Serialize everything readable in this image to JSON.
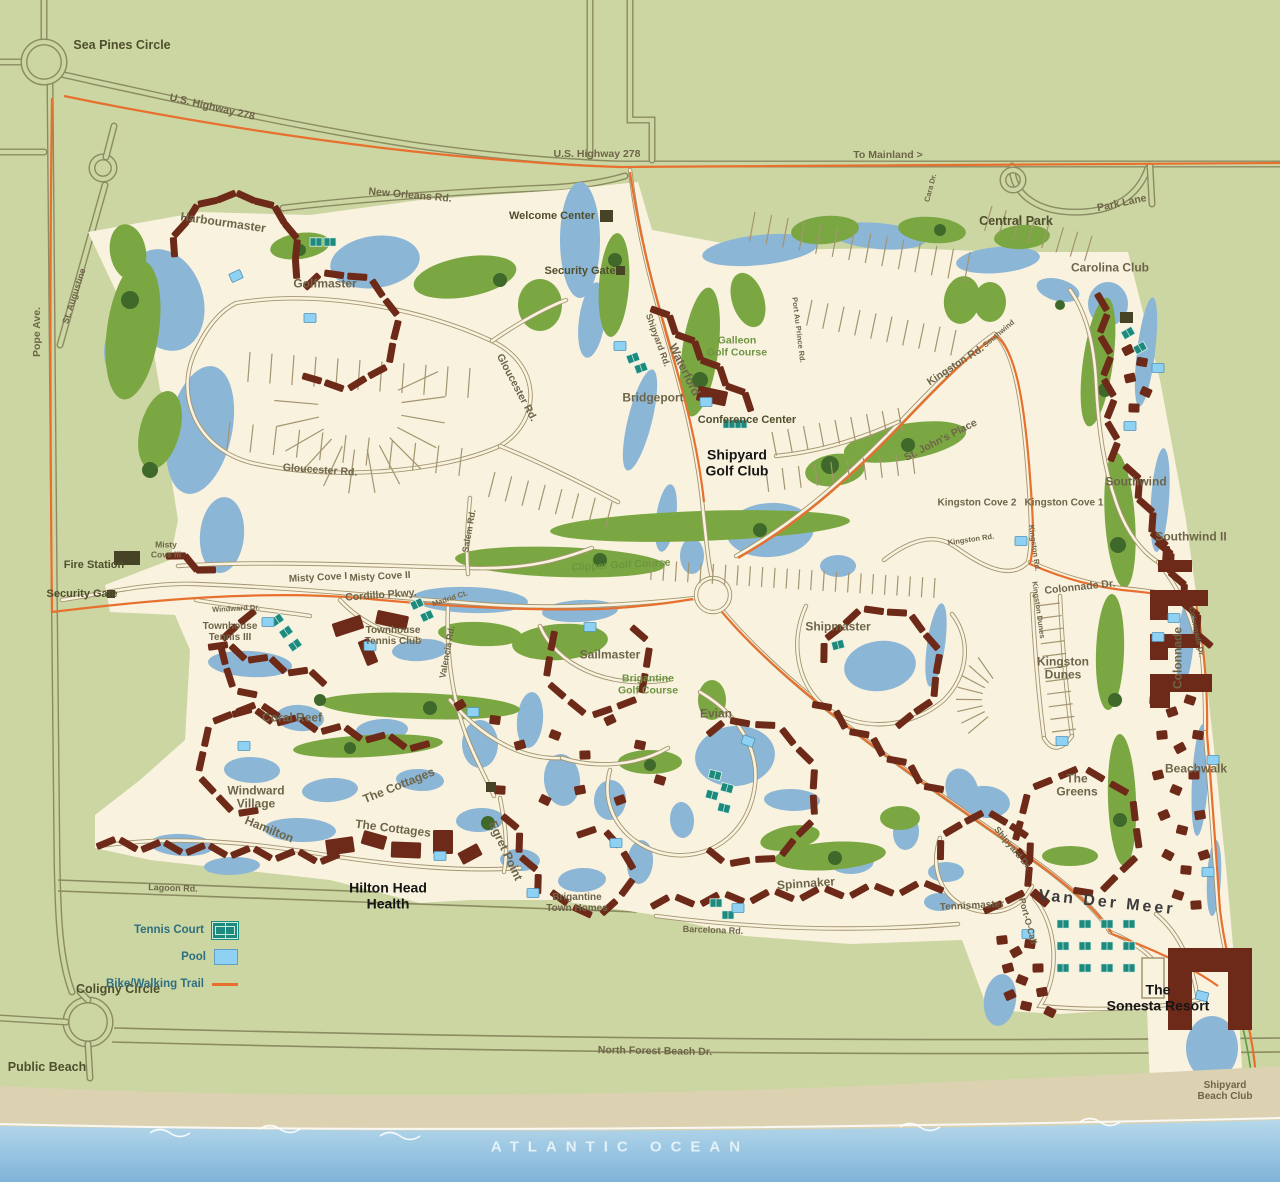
{
  "map": {
    "colors": {
      "background": "#ccd6a2",
      "parcel": "#f9f2df",
      "water": "#8cb6d6",
      "fairway": "#7ba743",
      "tree": "#3f682b",
      "building": "#6e2a18",
      "landmark": "#474326",
      "trail": "#e8702e",
      "tennis": "#1d8a7e",
      "pool": "#8ed1f2",
      "road_outer": "#8b8b62",
      "road_inner": "#a3956f",
      "sand": "#dcd2b2",
      "ocean_top": "#aed3e8",
      "ocean_bottom": "#7fb4d9"
    },
    "legend": {
      "items": [
        {
          "label": "Tennis Court",
          "icon": "tennis-court-icon"
        },
        {
          "label": "Pool",
          "icon": "pool-icon"
        },
        {
          "label": "Bike/Walking Trail",
          "icon": "trail-line-icon"
        }
      ]
    },
    "labels": [
      {
        "id": "sea-pines-circle",
        "text": "Sea Pines Circle",
        "x": 122,
        "y": 45,
        "rot": 0,
        "cls": "place"
      },
      {
        "id": "us-highway-278-west",
        "text": "U.S. Highway 278",
        "x": 212,
        "y": 108,
        "rot": 13,
        "cls": "road"
      },
      {
        "id": "us-highway-278",
        "text": "U.S. Highway 278",
        "x": 597,
        "y": 155,
        "rot": 0,
        "cls": "road"
      },
      {
        "id": "to-mainland",
        "text": "To Mainland >",
        "x": 888,
        "y": 156,
        "rot": 0,
        "cls": "road"
      },
      {
        "id": "pope-ave",
        "text": "Pope Ave.",
        "x": 38,
        "y": 332,
        "rot": -90,
        "cls": "road"
      },
      {
        "id": "st-augustine",
        "text": "St. Augustine",
        "x": 74,
        "y": 296,
        "rot": -72,
        "cls": "road-sm"
      },
      {
        "id": "new-orleans-rd",
        "text": "New Orleans Rd.",
        "x": 410,
        "y": 196,
        "rot": 5,
        "cls": "road"
      },
      {
        "id": "park-lane",
        "text": "Park Lane",
        "x": 1122,
        "y": 204,
        "rot": -12,
        "cls": "road"
      },
      {
        "id": "central-park",
        "text": "Central Park",
        "x": 1016,
        "y": 221,
        "rot": 0,
        "cls": "place"
      },
      {
        "id": "cara-dr",
        "text": "Cara Dr.",
        "x": 931,
        "y": 188,
        "rot": -75,
        "cls": "road-xs"
      },
      {
        "id": "welcome-center",
        "text": "Welcome Center",
        "x": 552,
        "y": 216,
        "rot": 0,
        "cls": "place-sm"
      },
      {
        "id": "security-gate-north",
        "text": "Security Gate",
        "x": 580,
        "y": 271,
        "rot": 0,
        "cls": "place-sm"
      },
      {
        "id": "harbourmaster",
        "text": "Harbourmaster",
        "x": 223,
        "y": 223,
        "rot": 8,
        "cls": "area"
      },
      {
        "id": "golfmaster",
        "text": "Golfmaster",
        "x": 325,
        "y": 284,
        "rot": 0,
        "cls": "area"
      },
      {
        "id": "carolina-club",
        "text": "Carolina Club",
        "x": 1110,
        "y": 268,
        "rot": 0,
        "cls": "area"
      },
      {
        "id": "shipyard-rd",
        "text": "Shipyard Rd.",
        "x": 658,
        "y": 340,
        "rot": 70,
        "cls": "road-sm"
      },
      {
        "id": "waterford",
        "text": "Waterford",
        "x": 684,
        "y": 370,
        "rot": 64,
        "cls": "area"
      },
      {
        "id": "galleon-golf-course",
        "text": "Galleon\nGolf Course",
        "x": 737,
        "y": 347,
        "rot": 0,
        "cls": "golf"
      },
      {
        "id": "bridgeport",
        "text": "Bridgeport",
        "x": 653,
        "y": 398,
        "rot": 0,
        "cls": "area"
      },
      {
        "id": "conference-center",
        "text": "Conference Center",
        "x": 747,
        "y": 420,
        "rot": 0,
        "cls": "place-sm"
      },
      {
        "id": "shipyard-golf-club",
        "text": "Shipyard\nGolf Club",
        "x": 737,
        "y": 463,
        "rot": 0,
        "cls": "bold"
      },
      {
        "id": "kingston-rd-upper",
        "text": "Kingston Rd.",
        "x": 956,
        "y": 366,
        "rot": -33,
        "cls": "road"
      },
      {
        "id": "port-au-prince-rd",
        "text": "Port Au Prince Rd.",
        "x": 798,
        "y": 330,
        "rot": 83,
        "cls": "road-xs"
      },
      {
        "id": "st-johns-place",
        "text": "St. John's Place",
        "x": 941,
        "y": 441,
        "rot": -27,
        "cls": "road"
      },
      {
        "id": "southwind-rd",
        "text": "Southwind",
        "x": 999,
        "y": 334,
        "rot": -40,
        "cls": "road-xs"
      },
      {
        "id": "kingston-cove-2",
        "text": "Kingston Cove 2",
        "x": 977,
        "y": 503,
        "rot": 0,
        "cls": "area-sm"
      },
      {
        "id": "kingston-cove-1",
        "text": "Kingston Cove 1",
        "x": 1064,
        "y": 503,
        "rot": 0,
        "cls": "area-sm"
      },
      {
        "id": "kingston-rd-lower",
        "text": "Kingston Rd.",
        "x": 971,
        "y": 540,
        "rot": -8,
        "cls": "road-xs"
      },
      {
        "id": "kingston-rd-vertical",
        "text": "Kingston Rd.",
        "x": 1034,
        "y": 548,
        "rot": 82,
        "cls": "road-xs"
      },
      {
        "id": "southwind",
        "text": "Southwind",
        "x": 1136,
        "y": 482,
        "rot": 0,
        "cls": "area"
      },
      {
        "id": "southwind-ii",
        "text": "Southwind II",
        "x": 1191,
        "y": 537,
        "rot": 0,
        "cls": "area"
      },
      {
        "id": "gloucester-rd-upper",
        "text": "Gloucester Rd.",
        "x": 516,
        "y": 388,
        "rot": 62,
        "cls": "road"
      },
      {
        "id": "gloucester-rd-lower",
        "text": "Gloucester Rd.",
        "x": 320,
        "y": 471,
        "rot": 4,
        "cls": "road"
      },
      {
        "id": "misty-cove-iii",
        "text": "Misty\nCove III",
        "x": 166,
        "y": 550,
        "rot": 0,
        "cls": "area-xs"
      },
      {
        "id": "fire-station",
        "text": "Fire Station",
        "x": 94,
        "y": 565,
        "rot": 0,
        "cls": "place-sm"
      },
      {
        "id": "security-gate-west",
        "text": "Security Gate",
        "x": 82,
        "y": 594,
        "rot": 0,
        "cls": "place-sm"
      },
      {
        "id": "misty-cove-i",
        "text": "Misty Cove I",
        "x": 318,
        "y": 578,
        "rot": -3,
        "cls": "area-sm"
      },
      {
        "id": "misty-cove-ii",
        "text": "Misty Cove II",
        "x": 380,
        "y": 577,
        "rot": -3,
        "cls": "area-sm"
      },
      {
        "id": "cordillo-pkwy",
        "text": "Cordillo Pkwy.",
        "x": 381,
        "y": 596,
        "rot": -4,
        "cls": "road"
      },
      {
        "id": "windward-dr",
        "text": "Windward Dr.",
        "x": 236,
        "y": 609,
        "rot": -3,
        "cls": "road-xs"
      },
      {
        "id": "townhouse-tennis-iii",
        "text": "Townhouse\nTennis III",
        "x": 230,
        "y": 632,
        "rot": 0,
        "cls": "area-sm"
      },
      {
        "id": "townhouse-tennis-club",
        "text": "Townhouse\nTennis Club",
        "x": 393,
        "y": 636,
        "rot": 0,
        "cls": "area-sm"
      },
      {
        "id": "madrid-ct",
        "text": "Madrid Ct.",
        "x": 450,
        "y": 599,
        "rot": -18,
        "cls": "road-xs"
      },
      {
        "id": "salem-rd",
        "text": "Salem Rd.",
        "x": 469,
        "y": 531,
        "rot": -80,
        "cls": "road-sm"
      },
      {
        "id": "valencia-rd",
        "text": "Valencia Rd.",
        "x": 447,
        "y": 652,
        "rot": -80,
        "cls": "road-sm"
      },
      {
        "id": "clipper-golf-course",
        "text": "Clipper Golf Course",
        "x": 621,
        "y": 566,
        "rot": -3,
        "cls": "golf"
      },
      {
        "id": "shipmaster",
        "text": "Shipmaster",
        "x": 838,
        "y": 627,
        "rot": 0,
        "cls": "area"
      },
      {
        "id": "colonnade-dr",
        "text": "Colonnade Dr.",
        "x": 1080,
        "y": 588,
        "rot": -6,
        "cls": "road"
      },
      {
        "id": "colonnade-dr-vertical",
        "text": "Colonnade Dr.",
        "x": 1196,
        "y": 632,
        "rot": 78,
        "cls": "road-xs"
      },
      {
        "id": "colonnade",
        "text": "Colonnade",
        "x": 1178,
        "y": 658,
        "rot": -90,
        "cls": "area"
      },
      {
        "id": "kingston-dunes-rd",
        "text": "Kingston Dunes",
        "x": 1038,
        "y": 610,
        "rot": 82,
        "cls": "road-xs"
      },
      {
        "id": "kingston-dunes",
        "text": "Kingston\nDunes",
        "x": 1063,
        "y": 669,
        "rot": 0,
        "cls": "area"
      },
      {
        "id": "sailmaster",
        "text": "Sailmaster",
        "x": 610,
        "y": 655,
        "rot": 0,
        "cls": "area"
      },
      {
        "id": "brigantine-golf-course",
        "text": "Brigantine\nGolf Course",
        "x": 648,
        "y": 685,
        "rot": 0,
        "cls": "golf"
      },
      {
        "id": "evian",
        "text": "Evian",
        "x": 716,
        "y": 714,
        "rot": 0,
        "cls": "area"
      },
      {
        "id": "coral-reef",
        "text": "Coral Reef",
        "x": 292,
        "y": 718,
        "rot": 0,
        "cls": "area"
      },
      {
        "id": "windward-village",
        "text": "Windward\nVillage",
        "x": 256,
        "y": 798,
        "rot": 0,
        "cls": "area"
      },
      {
        "id": "the-cottages-upper",
        "text": "The Cottages",
        "x": 399,
        "y": 786,
        "rot": -22,
        "cls": "area"
      },
      {
        "id": "the-cottages-lower",
        "text": "The Cottages",
        "x": 393,
        "y": 829,
        "rot": 7,
        "cls": "area"
      },
      {
        "id": "hamilton",
        "text": "Hamilton",
        "x": 269,
        "y": 830,
        "rot": 22,
        "cls": "area"
      },
      {
        "id": "egret-point",
        "text": "Egret Point",
        "x": 505,
        "y": 851,
        "rot": 65,
        "cls": "area"
      },
      {
        "id": "hilton-head-health",
        "text": "Hilton Head\nHealth",
        "x": 388,
        "y": 896,
        "rot": 0,
        "cls": "bold"
      },
      {
        "id": "brigantine-town-homes",
        "text": "Brigantine\nTown Homes",
        "x": 577,
        "y": 903,
        "rot": 0,
        "cls": "area-sm"
      },
      {
        "id": "spinnaker",
        "text": "Spinnaker",
        "x": 806,
        "y": 884,
        "rot": -4,
        "cls": "area"
      },
      {
        "id": "barcelona-rd",
        "text": "Barcelona Rd.",
        "x": 713,
        "y": 930,
        "rot": 2,
        "cls": "road-sm"
      },
      {
        "id": "tennismaster",
        "text": "Tennismaster",
        "x": 972,
        "y": 906,
        "rot": -3,
        "cls": "area-sm"
      },
      {
        "id": "shipyard-dr",
        "text": "Shipyard Dr.",
        "x": 1013,
        "y": 848,
        "rot": 50,
        "cls": "road-sm"
      },
      {
        "id": "port-o-call",
        "text": "Port-O-Call",
        "x": 1028,
        "y": 921,
        "rot": 75,
        "cls": "road-sm"
      },
      {
        "id": "van-der-meer",
        "text": "Van Der Meer",
        "x": 1107,
        "y": 903,
        "rot": 6,
        "cls": "big"
      },
      {
        "id": "the-greens",
        "text": "The\nGreens",
        "x": 1077,
        "y": 786,
        "rot": 0,
        "cls": "area"
      },
      {
        "id": "beachwalk",
        "text": "Beachwalk",
        "x": 1196,
        "y": 769,
        "rot": 0,
        "cls": "area"
      },
      {
        "id": "the-sonesta-resort",
        "text": "The\nSonesta Resort",
        "x": 1158,
        "y": 998,
        "rot": 0,
        "cls": "bold"
      },
      {
        "id": "shipyard-beach-club",
        "text": "Shipyard\nBeach Club",
        "x": 1225,
        "y": 1091,
        "rot": 0,
        "cls": "area-sm"
      },
      {
        "id": "coligny-circle",
        "text": "Coligny Circle",
        "x": 118,
        "y": 989,
        "rot": 0,
        "cls": "place"
      },
      {
        "id": "public-beach",
        "text": "Public Beach",
        "x": 47,
        "y": 1067,
        "rot": 0,
        "cls": "place"
      },
      {
        "id": "north-forest-beach-dr",
        "text": "North Forest Beach Dr.",
        "x": 655,
        "y": 1052,
        "rot": 1,
        "cls": "road"
      },
      {
        "id": "lagoon-rd",
        "text": "Lagoon Rd.",
        "x": 173,
        "y": 888,
        "rot": 2,
        "cls": "road-sm"
      },
      {
        "id": "atlantic-ocean",
        "text": "ATLANTIC OCEAN",
        "x": 620,
        "y": 1148,
        "rot": 0,
        "cls": "ocean"
      }
    ]
  }
}
